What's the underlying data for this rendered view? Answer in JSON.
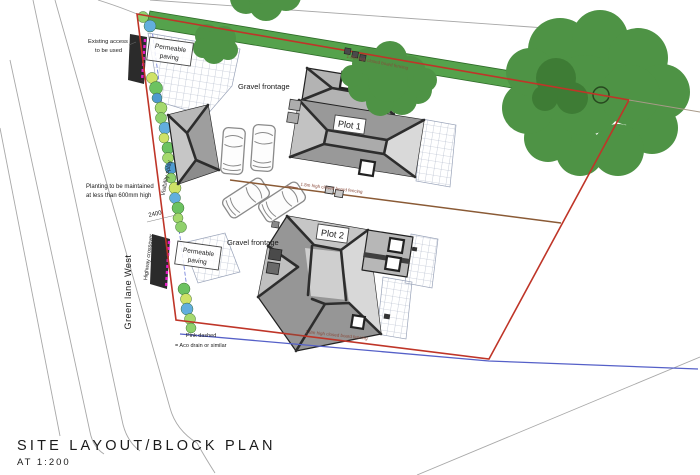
{
  "title": {
    "line1": "SITE LAYOUT/BLOCK PLAN",
    "line2": "AT 1:200"
  },
  "labels": {
    "existing_access_1": "Existing access",
    "existing_access_2": "to be used",
    "permeable_line1": "Permeable",
    "permeable_line2": "paving",
    "gravel_frontage": "Gravel frontage",
    "plot1": "Plot 1",
    "plot2": "Plot 2",
    "planting_note_1": "Planting to be maintained",
    "planting_note_2": "at less than 600mm high",
    "green_lane": "Green lane West",
    "highway_crossover": "Highway crossover",
    "visibility_splay": "Visibility splay",
    "dim_2400": "2400",
    "fence_note": "1.8m high closed board fencing",
    "pink_dashed_1": "Pink dashed",
    "pink_dashed_2": "= Aco drain or similar"
  },
  "colors": {
    "boundary_red": "#bf3528",
    "drain_blue": "#5560c8",
    "aco_pink": "#e61ec8",
    "hedge_green": "#55a24c",
    "tree_green": "#4e9345",
    "fence_brown": "#8a5a35",
    "access_black": "#2b2b2b",
    "splay_text_blue": "#5560c8"
  }
}
